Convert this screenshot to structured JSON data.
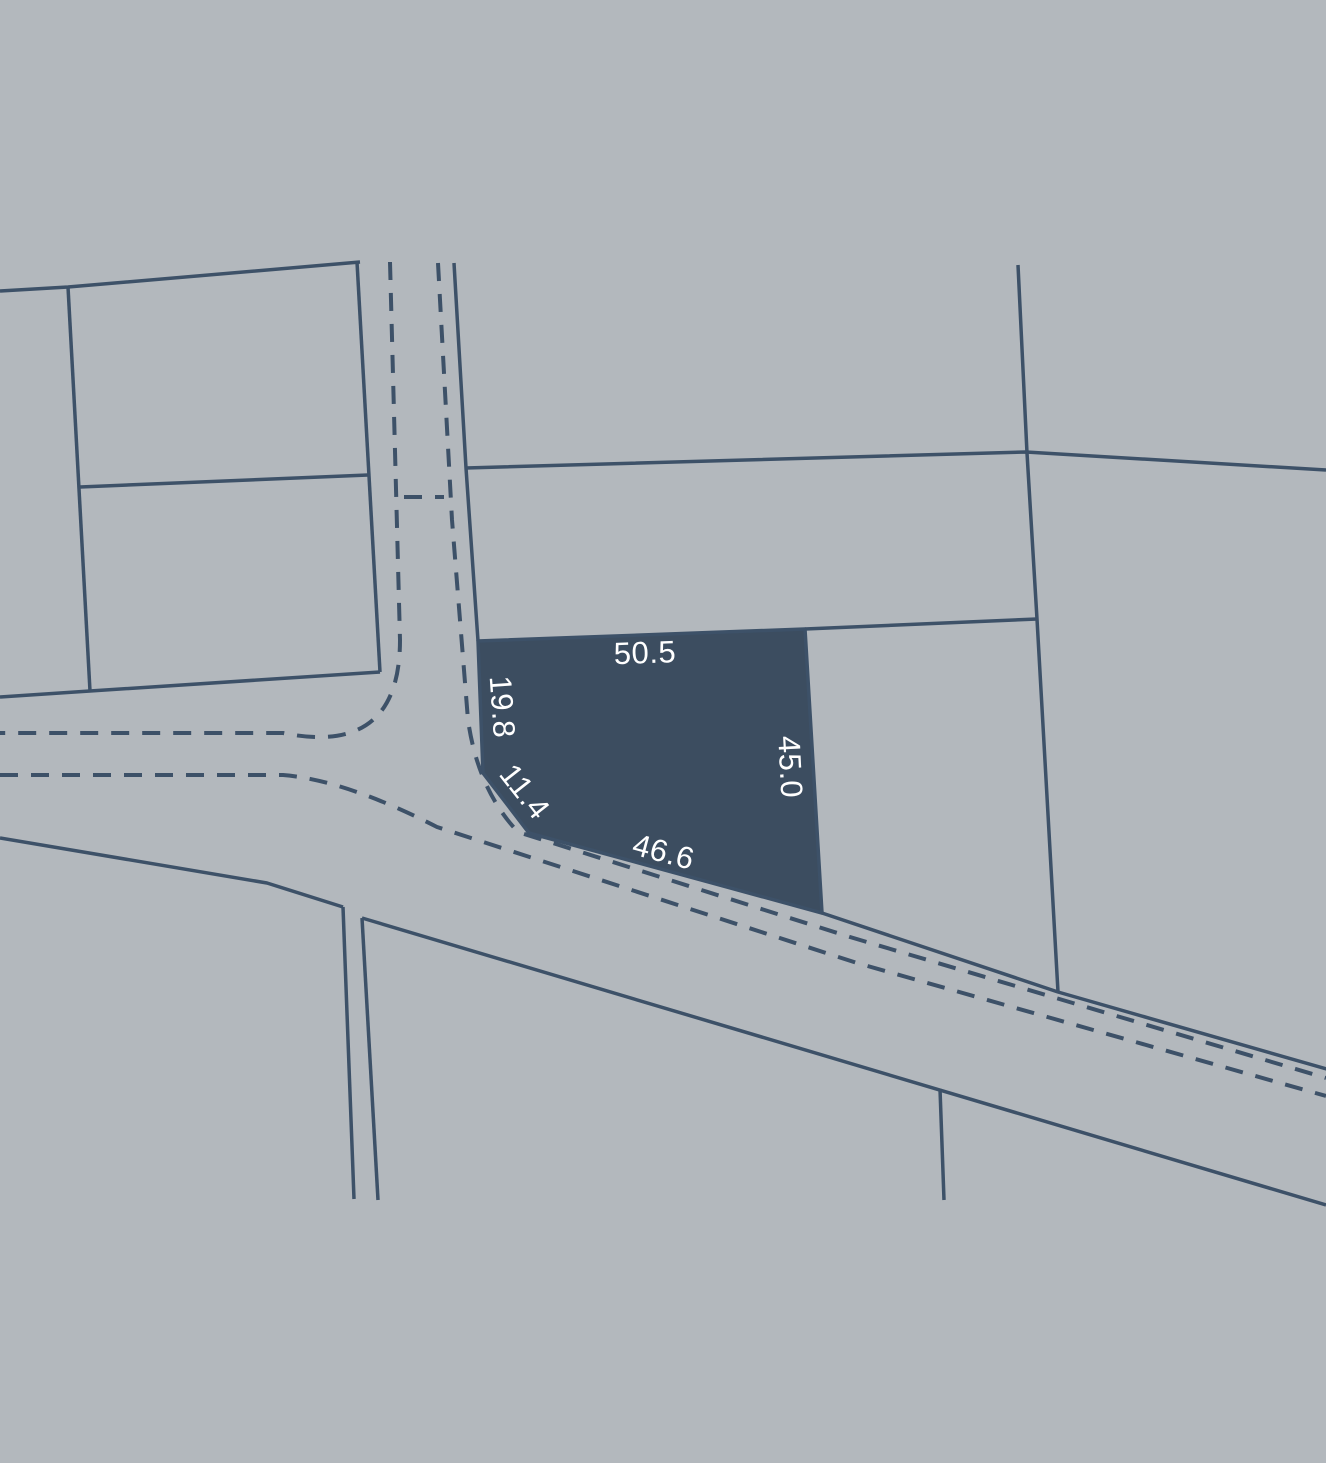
{
  "canvas": {
    "width": 1326,
    "height": 1463,
    "background_color": "#b3b8bd",
    "line_color": "#3d5168",
    "parcel_fill_color": "#3c4d60",
    "label_color": "#ffffff",
    "label_font_size": 31
  },
  "map": {
    "highlight_parcel": {
      "name": "highlighted-parcel",
      "points": [
        [
          478,
          641
        ],
        [
          805,
          629
        ],
        [
          822,
          913
        ],
        [
          529,
          833
        ],
        [
          483,
          773
        ]
      ],
      "dimension_labels": [
        {
          "name": "dimension-label-top",
          "text": "50.5",
          "x": 645,
          "y": 655,
          "rotation": -2
        },
        {
          "name": "dimension-label-left",
          "text": "19.8",
          "x": 500,
          "y": 707,
          "rotation": 86
        },
        {
          "name": "dimension-label-chamfer",
          "text": "11.4",
          "x": 523,
          "y": 793,
          "rotation": 52
        },
        {
          "name": "dimension-label-right",
          "text": "45.0",
          "x": 788,
          "y": 767,
          "rotation": 87
        },
        {
          "name": "dimension-label-bottom",
          "text": "46.6",
          "x": 663,
          "y": 854,
          "rotation": 15
        }
      ]
    },
    "boundary_lines": [
      {
        "name": "left-block-top-edge",
        "points": [
          [
            0,
            291
          ],
          [
            68,
            287
          ],
          [
            360,
            262
          ]
        ]
      },
      {
        "name": "left-block-vertical-divider",
        "points": [
          [
            68,
            287
          ],
          [
            90,
            691
          ]
        ]
      },
      {
        "name": "left-block-horizontal-divider",
        "points": [
          [
            80,
            487
          ],
          [
            368,
            475
          ]
        ]
      },
      {
        "name": "left-block-bottom-edge",
        "points": [
          [
            0,
            697
          ],
          [
            90,
            691
          ],
          [
            380,
            672
          ]
        ]
      },
      {
        "name": "left-block-right-edge",
        "points": [
          [
            357,
            262
          ],
          [
            380,
            672
          ]
        ]
      },
      {
        "name": "vertical-road-east-edge",
        "points": [
          [
            454,
            263
          ],
          [
            466,
            468
          ],
          [
            478,
            641
          ]
        ]
      },
      {
        "name": "long-horizontal-boundary",
        "points": [
          [
            466,
            468
          ],
          [
            1026,
            452
          ],
          [
            1326,
            470
          ]
        ]
      },
      {
        "name": "right-parcel-vertical-boundary",
        "points": [
          [
            1018,
            265
          ],
          [
            1027,
            453
          ],
          [
            1037,
            619
          ],
          [
            1058,
            992
          ]
        ]
      },
      {
        "name": "mid-horizontal-boundary",
        "points": [
          [
            805,
            629
          ],
          [
            1037,
            619
          ]
        ]
      },
      {
        "name": "diagonal-road-north-edge",
        "points": [
          [
            822,
            913
          ],
          [
            1058,
            992
          ],
          [
            1330,
            1070
          ]
        ]
      },
      {
        "name": "road-south-edge-west",
        "points": [
          [
            0,
            838
          ],
          [
            267,
            883
          ],
          [
            343,
            907
          ]
        ]
      },
      {
        "name": "road-south-edge-east",
        "points": [
          [
            362,
            918
          ],
          [
            1326,
            1205
          ]
        ]
      },
      {
        "name": "notch-boundary-west",
        "points": [
          [
            343,
            907
          ],
          [
            354,
            1199
          ]
        ]
      },
      {
        "name": "notch-boundary-east",
        "points": [
          [
            362,
            918
          ],
          [
            378,
            1200
          ]
        ]
      },
      {
        "name": "south-parcel-divider",
        "points": [
          [
            940,
            1089
          ],
          [
            944,
            1200
          ]
        ]
      }
    ],
    "road_dashed_lines": [
      {
        "name": "road-dashline-west-north",
        "path": "M 390,262 L 400,640 Q 400,757 283,733 L 0,733"
      },
      {
        "name": "road-dashline-south",
        "path": "M 0,775 L 283,775 Q 345,780 437,827 L 857,963 L 1326,1096"
      },
      {
        "name": "road-dashline-east-north",
        "path": "M 438,263 L 452,520 L 468,720 Q 478,790 518,832 L 850,937 L 1326,1078"
      },
      {
        "name": "road-dashline-crossing",
        "path": "M 404,497 L 444,497"
      }
    ],
    "style": {
      "solid_stroke_width": 3.5,
      "dashed_stroke_width": 4,
      "dash_pattern": "18 13"
    }
  }
}
